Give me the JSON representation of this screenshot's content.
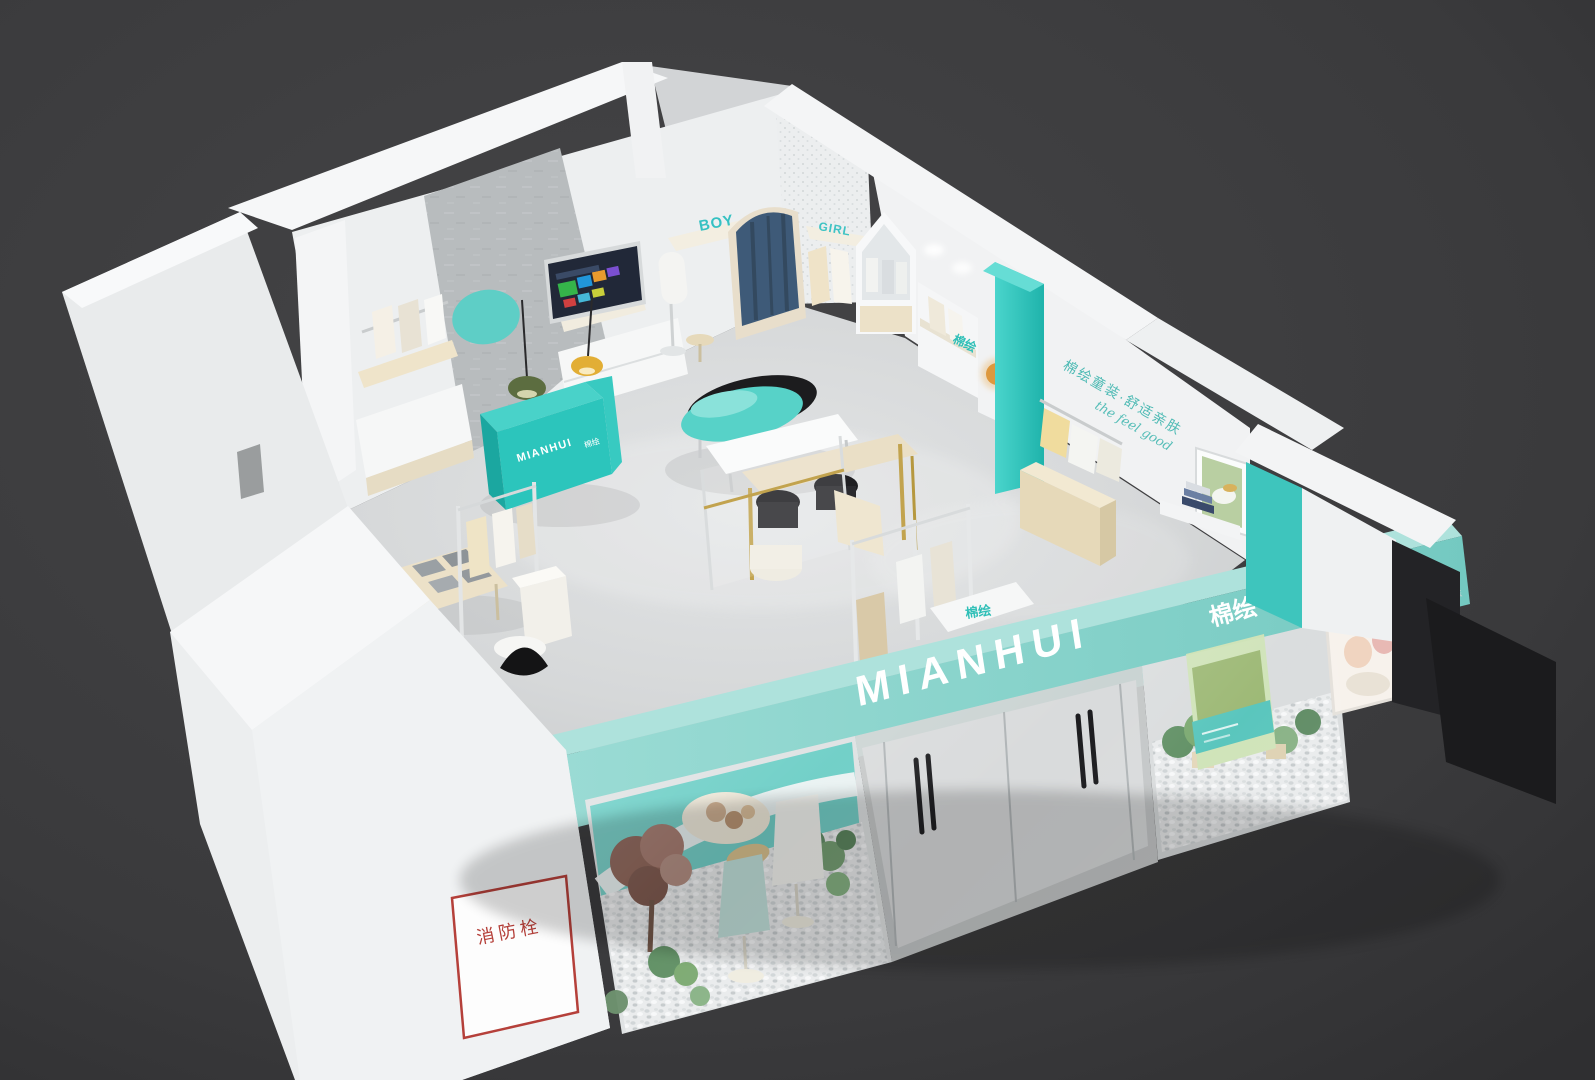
{
  "scene": {
    "type": "3d-interior-render",
    "subject": "MIANHUI (棉绘) children's clothing store — axonometric cutaway 3D render",
    "background_color": "#3a3a3c",
    "palette": {
      "brand_teal": "#2fc4bb",
      "fascia_teal": "#8ad2cb",
      "wall_white": "#eff1f2",
      "floor_gray": "#d6d8d9",
      "concrete_gray": "#b8bcbe",
      "wood_birch": "#ecdfc4",
      "curtain_navy": "#3e5a78",
      "lamp_yellow": "#e2ae35",
      "lamp_green": "#5c6d40",
      "fire_red": "#b5403a"
    }
  },
  "storefront": {
    "fascia_logo_latin": "MIANHUI",
    "fascia_logo_cn": "棉绘",
    "side_text": "MIANHUI 棉绘"
  },
  "signs": {
    "boy_shelf": "BOY",
    "girl_shelf": "GIRL",
    "cashier_logo_latin": "MIANHUI",
    "cashier_logo_cn": "棉绘",
    "shelf_decor_cn": "棉绘",
    "front_table_decor_cn": "棉绘",
    "fire_hydrant_panel": "消防栓"
  },
  "wall_slogan": {
    "line1_cn": "棉绘童装·舒适亲肤",
    "line2_script": "the feel good"
  }
}
